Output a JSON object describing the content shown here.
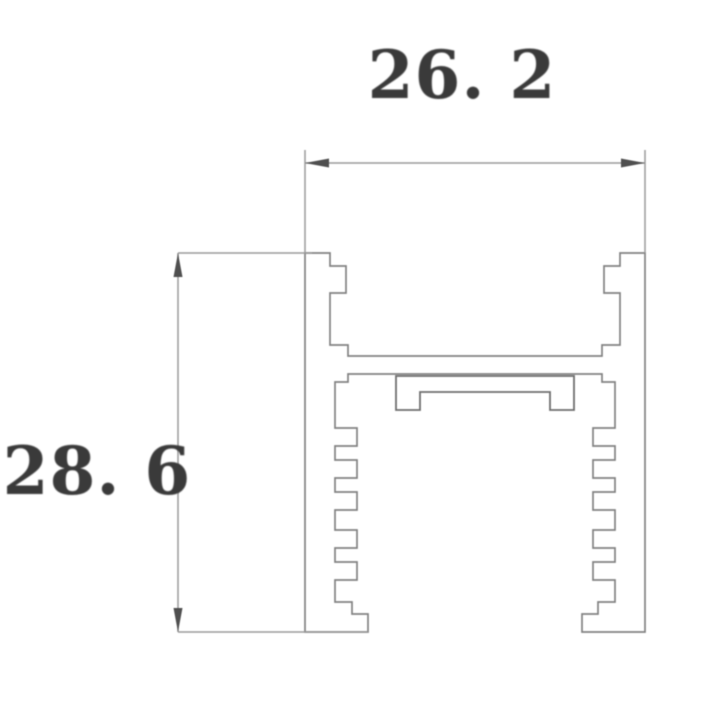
{
  "dimensions": {
    "width_label": "26. 2",
    "height_label": "28. 6"
  },
  "colors": {
    "background": "#ffffff",
    "profile_line": "#828282",
    "insert_line": "#6f6f6f",
    "dimension_line": "#9a9a9a",
    "arrow": "#4f4f4f",
    "text": "#3a3a3a"
  },
  "drawing": {
    "canvas": {
      "width": 720,
      "height": 703
    },
    "arrow": {
      "length": 24,
      "halfwidth": 4.5
    },
    "profile_outline": [
      [
        305,
        253
      ],
      [
        330,
        253
      ],
      [
        330,
        266
      ],
      [
        346,
        266
      ],
      [
        346,
        293
      ],
      [
        330,
        293
      ],
      [
        330,
        345
      ],
      [
        348,
        345
      ],
      [
        348,
        356
      ],
      [
        602,
        356
      ],
      [
        602,
        345
      ],
      [
        620,
        345
      ],
      [
        620,
        293
      ],
      [
        604,
        293
      ],
      [
        604,
        266
      ],
      [
        620,
        266
      ],
      [
        620,
        253
      ],
      [
        645,
        253
      ],
      [
        645,
        632
      ],
      [
        582,
        632
      ],
      [
        582,
        614
      ],
      [
        598,
        614
      ],
      [
        598,
        602
      ],
      [
        615,
        602
      ],
      [
        615,
        580
      ],
      [
        593,
        580
      ],
      [
        593,
        562
      ],
      [
        615,
        562
      ],
      [
        615,
        548
      ],
      [
        593,
        548
      ],
      [
        593,
        530
      ],
      [
        615,
        530
      ],
      [
        615,
        510
      ],
      [
        593,
        510
      ],
      [
        593,
        492
      ],
      [
        615,
        492
      ],
      [
        615,
        478
      ],
      [
        593,
        478
      ],
      [
        593,
        460
      ],
      [
        615,
        460
      ],
      [
        615,
        446
      ],
      [
        593,
        446
      ],
      [
        593,
        428
      ],
      [
        615,
        428
      ],
      [
        615,
        382
      ],
      [
        602,
        382
      ],
      [
        602,
        374
      ],
      [
        348,
        374
      ],
      [
        348,
        382
      ],
      [
        335,
        382
      ],
      [
        335,
        428
      ],
      [
        357,
        428
      ],
      [
        357,
        446
      ],
      [
        335,
        446
      ],
      [
        335,
        460
      ],
      [
        357,
        460
      ],
      [
        357,
        478
      ],
      [
        335,
        478
      ],
      [
        335,
        492
      ],
      [
        357,
        492
      ],
      [
        357,
        510
      ],
      [
        335,
        510
      ],
      [
        335,
        530
      ],
      [
        357,
        530
      ],
      [
        357,
        548
      ],
      [
        335,
        548
      ],
      [
        335,
        562
      ],
      [
        357,
        562
      ],
      [
        357,
        580
      ],
      [
        335,
        580
      ],
      [
        335,
        602
      ],
      [
        352,
        602
      ],
      [
        352,
        614
      ],
      [
        368,
        614
      ],
      [
        368,
        632
      ],
      [
        305,
        632
      ]
    ],
    "insert_outline": [
      [
        396,
        376
      ],
      [
        574,
        376
      ],
      [
        574,
        410
      ],
      [
        550,
        410
      ],
      [
        550,
        392
      ],
      [
        420,
        392
      ],
      [
        420,
        410
      ],
      [
        396,
        410
      ]
    ],
    "dim_lines": [
      {
        "name": "width-dim-line",
        "x1": 305,
        "y1": 163,
        "x2": 645,
        "y2": 163
      },
      {
        "name": "width-ext-line-left",
        "x1": 305,
        "y1": 150,
        "x2": 305,
        "y2": 253
      },
      {
        "name": "width-ext-line-right",
        "x1": 645,
        "y1": 150,
        "x2": 645,
        "y2": 253
      },
      {
        "name": "height-dim-line",
        "x1": 178,
        "y1": 253,
        "x2": 178,
        "y2": 632
      },
      {
        "name": "height-ext-line-top",
        "x1": 178,
        "y1": 253,
        "x2": 312,
        "y2": 253
      },
      {
        "name": "height-ext-line-bottom",
        "x1": 178,
        "y1": 632,
        "x2": 368,
        "y2": 632
      }
    ],
    "arrows": [
      {
        "name": "width-arrow-left",
        "x": 305,
        "y": 163,
        "dir": "left"
      },
      {
        "name": "width-arrow-right",
        "x": 645,
        "y": 163,
        "dir": "right"
      },
      {
        "name": "height-arrow-top",
        "x": 178,
        "y": 253,
        "dir": "up"
      },
      {
        "name": "height-arrow-bottom",
        "x": 178,
        "y": 632,
        "dir": "down"
      }
    ]
  }
}
